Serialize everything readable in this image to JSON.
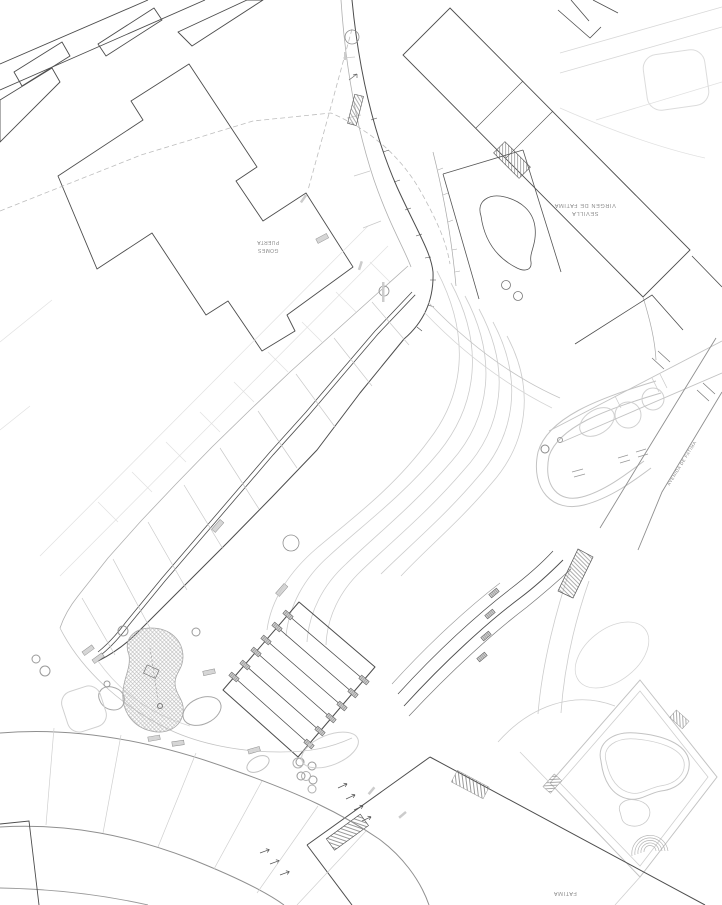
{
  "meta": {
    "drawing_type": "Architectural site plan (CAD line drawing, landscape/urbanization project)",
    "background": "#ffffff",
    "orientation_note": "building and street labels are drawn rotated 180 degrees on the plan"
  },
  "palette": {
    "dark_line": "#4d4d4d",
    "medium_line": "#8f8f8f",
    "light_line": "#c3c3c3",
    "faint_line": "#dcdcdc",
    "hatch_line": "#8a8a8a",
    "label_text": "#8a8a8a"
  },
  "labels": {
    "left_building": {
      "lines": [
        "GOMES",
        "PUERTA"
      ],
      "rotation_deg": 180
    },
    "school_building": {
      "lines": [
        "SEVILLA",
        "VIRGEN DE FATIMA"
      ],
      "rotation_deg": 180
    },
    "street_right": {
      "text": "AVENIDA DE FATIMA",
      "rotation_deg": -58
    },
    "bottom_street": {
      "text": "FATIMA",
      "rotation_deg": 180
    }
  },
  "features": {
    "buildings": [
      "top-left housing blocks",
      "large notched building west (Puerta Gomes)",
      "school building Sevilla Virgen de Fatima",
      "south annex building"
    ],
    "landscape": [
      "curved pedestrian promenade with paving joints and benches",
      "central amphitheatre stair with stepped tabs",
      "curved garden terraces east of the stair",
      "children's playground area (cross-hatched kidney shape)",
      "kidney-shaped pool with diamond deck and corner steps",
      "hairpin garden path with tree circles",
      "wide curved road at the south-west corner"
    ]
  }
}
